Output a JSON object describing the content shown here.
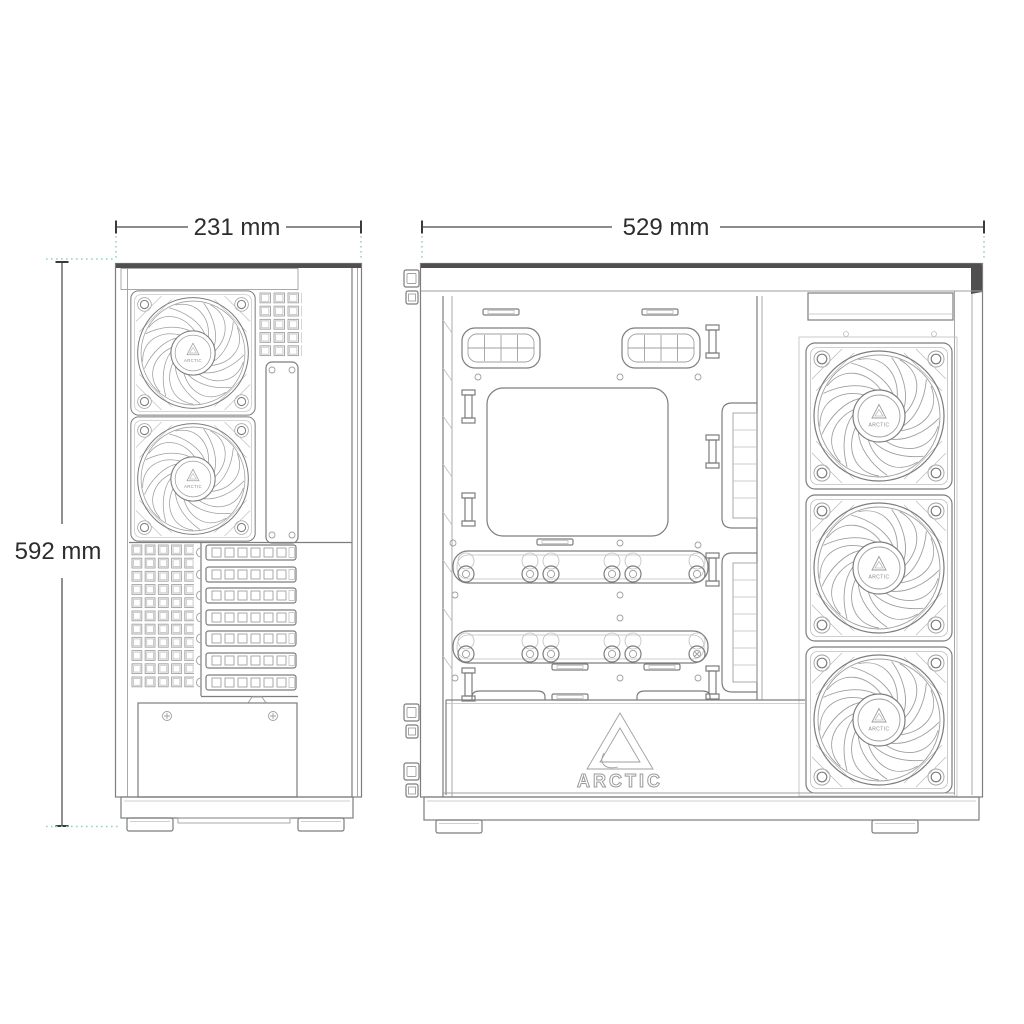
{
  "brand": {
    "name": "ARCTIC"
  },
  "colors": {
    "background": "#ffffff",
    "line": "#7d7d7d",
    "line_dark": "#4a4a4a",
    "dimension_text": "#2d2d2d",
    "extension_line_teal": "#8fd2cf"
  },
  "dimensions": {
    "front_width_label": "231 mm",
    "height_label": "592 mm",
    "depth_label": "529 mm"
  },
  "views": {
    "rear": {
      "fan_count": 2,
      "pci_slot_count": 7,
      "fan_hub_logo": "ARCTIC"
    },
    "side": {
      "fan_count": 3,
      "shroud_logo": "ARCTIC",
      "fan_hub_logo": "ARCTIC"
    }
  }
}
